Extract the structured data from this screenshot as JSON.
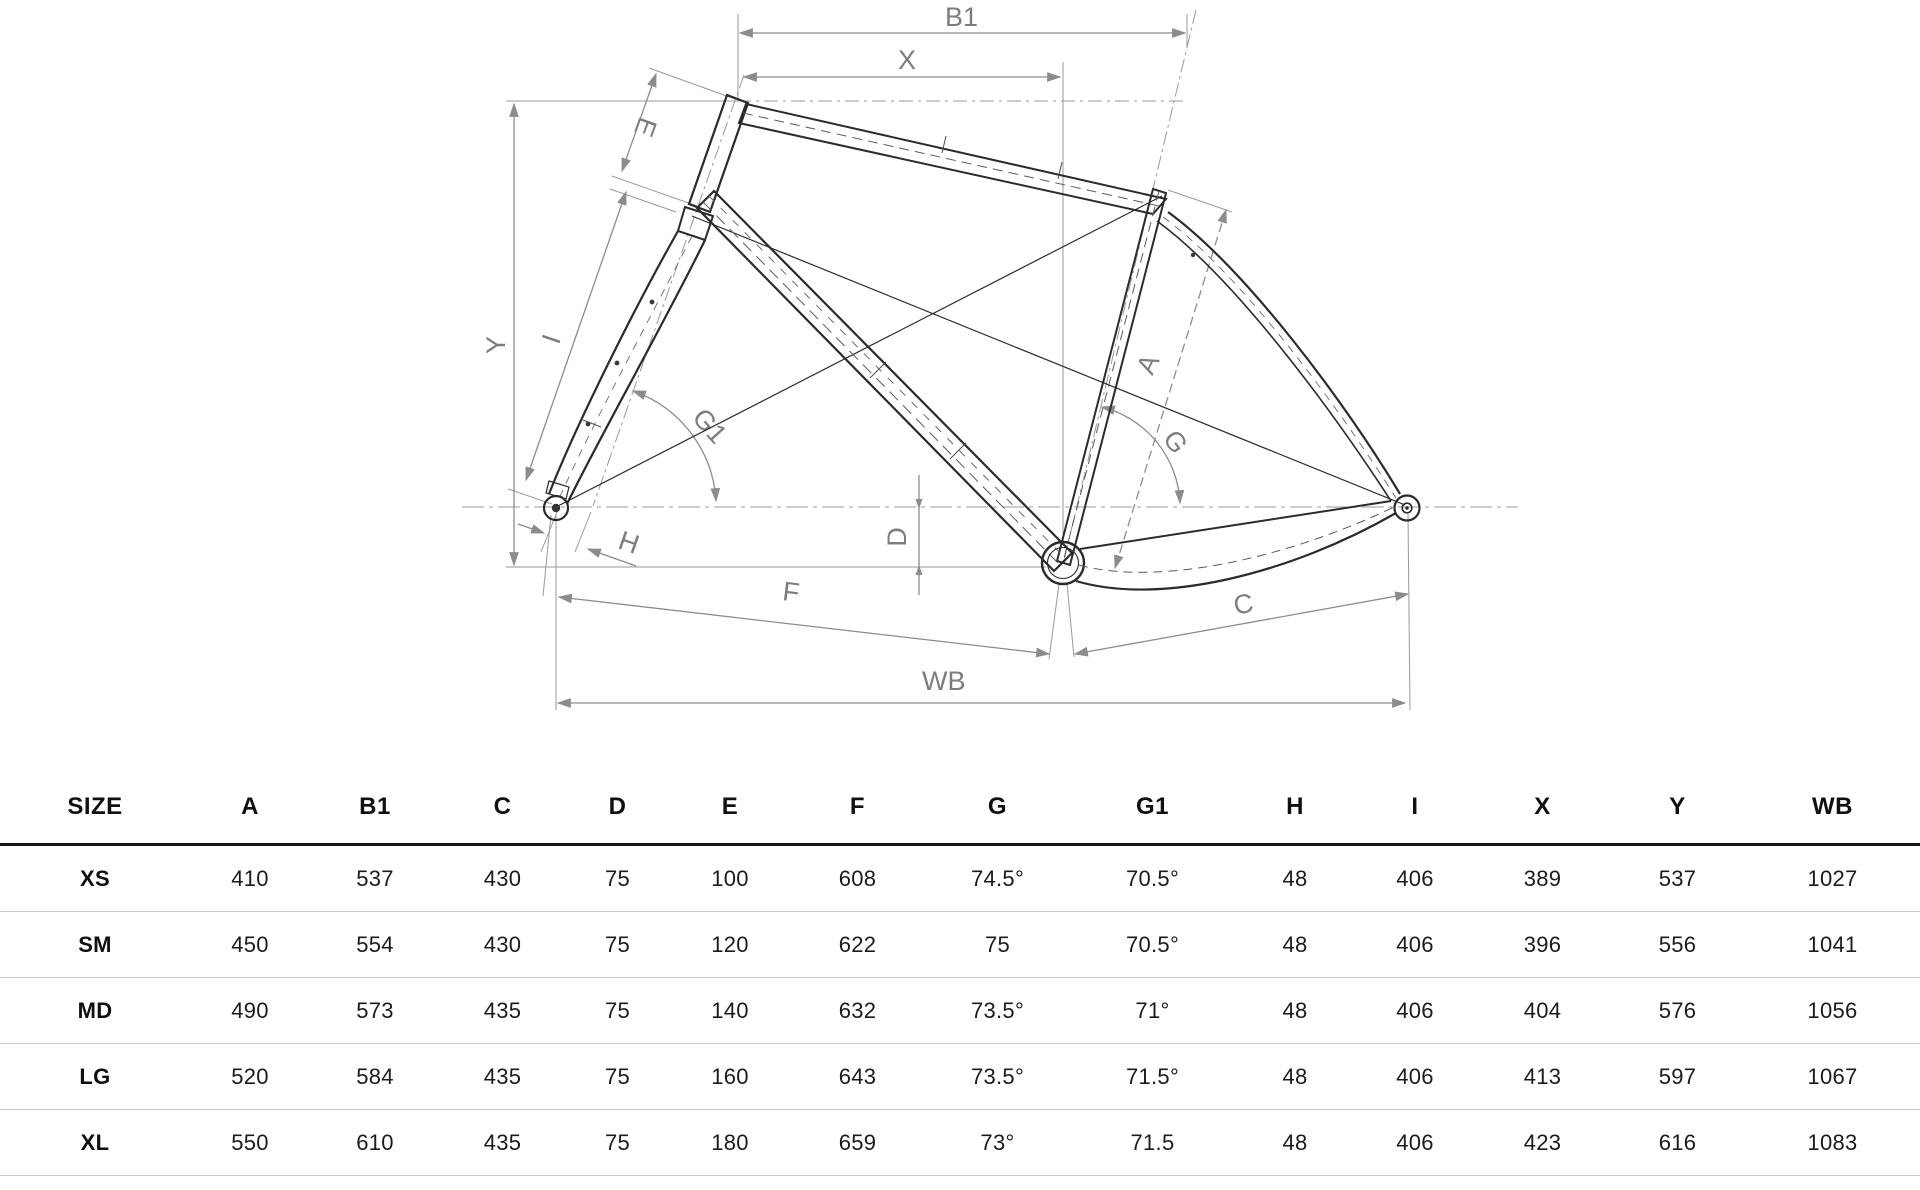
{
  "diagram": {
    "title_hint": "bicycle-frame-geometry-drawing",
    "labels": {
      "B1": "B1",
      "X": "X",
      "E": "E",
      "Y": "Y",
      "I": "I",
      "G1": "G1",
      "H": "H",
      "D": "D",
      "F": "F",
      "WB": "WB",
      "A": "A",
      "G": "G",
      "C": "C"
    }
  },
  "table": {
    "columns": [
      "SIZE",
      "A",
      "B1",
      "C",
      "D",
      "E",
      "F",
      "G",
      "G1",
      "H",
      "I",
      "X",
      "Y",
      "WB"
    ],
    "rows": [
      [
        "XS",
        "410",
        "537",
        "430",
        "75",
        "100",
        "608",
        "74.5°",
        "70.5°",
        "48",
        "406",
        "389",
        "537",
        "1027"
      ],
      [
        "SM",
        "450",
        "554",
        "430",
        "75",
        "120",
        "622",
        "75",
        "70.5°",
        "48",
        "406",
        "396",
        "556",
        "1041"
      ],
      [
        "MD",
        "490",
        "573",
        "435",
        "75",
        "140",
        "632",
        "73.5°",
        "71°",
        "48",
        "406",
        "404",
        "576",
        "1056"
      ],
      [
        "LG",
        "520",
        "584",
        "435",
        "75",
        "160",
        "643",
        "73.5°",
        "71.5°",
        "48",
        "406",
        "413",
        "597",
        "1067"
      ],
      [
        "XL",
        "550",
        "610",
        "435",
        "75",
        "180",
        "659",
        "73°",
        "71.5",
        "48",
        "406",
        "423",
        "616",
        "1083"
      ]
    ]
  },
  "chart_data": {
    "type": "table",
    "title": "Bicycle frame geometry by size",
    "columns": [
      "SIZE",
      "A",
      "B1",
      "C",
      "D",
      "E",
      "F",
      "G",
      "G1",
      "H",
      "I",
      "X",
      "Y",
      "WB"
    ],
    "rows": [
      [
        "XS",
        "410",
        "537",
        "430",
        "75",
        "100",
        "608",
        "74.5°",
        "70.5°",
        "48",
        "406",
        "389",
        "537",
        "1027"
      ],
      [
        "SM",
        "450",
        "554",
        "430",
        "75",
        "120",
        "622",
        "75",
        "70.5°",
        "48",
        "406",
        "396",
        "556",
        "1041"
      ],
      [
        "MD",
        "490",
        "573",
        "435",
        "75",
        "140",
        "632",
        "73.5°",
        "71°",
        "48",
        "406",
        "404",
        "576",
        "1056"
      ],
      [
        "LG",
        "520",
        "584",
        "435",
        "75",
        "160",
        "643",
        "73.5°",
        "71.5°",
        "48",
        "406",
        "413",
        "597",
        "1067"
      ],
      [
        "XL",
        "550",
        "610",
        "435",
        "75",
        "180",
        "659",
        "73°",
        "71.5",
        "48",
        "406",
        "423",
        "616",
        "1083"
      ]
    ]
  },
  "colors": {
    "frame_line": "#2b2b2b",
    "dimension_line": "#8c8c8c",
    "dimension_text": "#7d7d7d",
    "table_rule_heavy": "#161616",
    "table_rule_light": "#c9c9c9",
    "background": "#ffffff"
  }
}
